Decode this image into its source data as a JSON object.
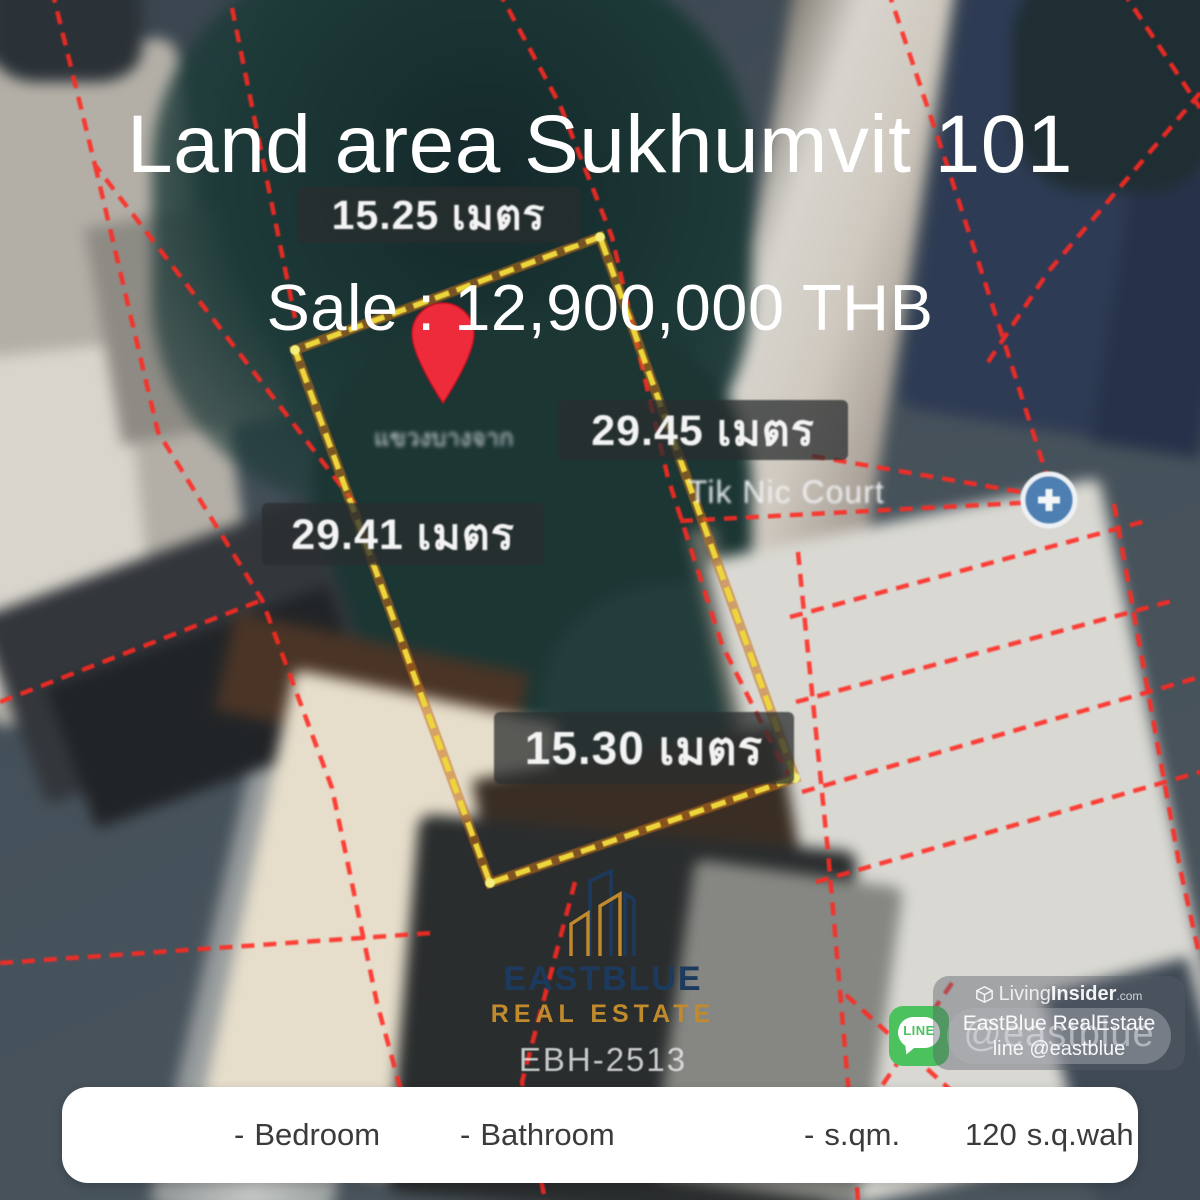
{
  "header": {
    "title": "Land area Sukhumvit 101",
    "price": "Sale : 12,900,000 THB"
  },
  "map_overlay": {
    "measurements": {
      "top": "15.25 เมตร",
      "right": "29.45 เมตร",
      "left": "29.41 เมตร",
      "bottom": "15.30 เมตร"
    },
    "street_label": "แขวงบางจาก",
    "place_label": "Tik Nic Court",
    "colors": {
      "plot_outline": "#ecd63c",
      "plot_glow": "#c87118",
      "parcel_lines": "#ff2a22",
      "pin": "#ee2b3b",
      "place_icon_blue": "#4d7fb3"
    }
  },
  "branding": {
    "name": "EASTBLUE",
    "subtitle": "REAL ESTATE",
    "listing_code": "EBH-2513",
    "navy": "#1c3a5e",
    "gold": "#c08a2d"
  },
  "watermark": {
    "platform_light": "Living",
    "platform_bold": "Insider",
    "platform_tld": ".com",
    "agent": "EastBlue RealEstate",
    "handle": "@eastblue",
    "line_text": "line @eastblue",
    "line_label": "LINE",
    "line_green": "#4bc25e"
  },
  "details_bar": {
    "items": [
      {
        "value": "-",
        "label": "Bedroom"
      },
      {
        "value": "-",
        "label": "Bathroom"
      },
      {
        "value": "-",
        "label": "s.qm."
      },
      {
        "value": "120",
        "label": "s.q.wah"
      }
    ]
  }
}
